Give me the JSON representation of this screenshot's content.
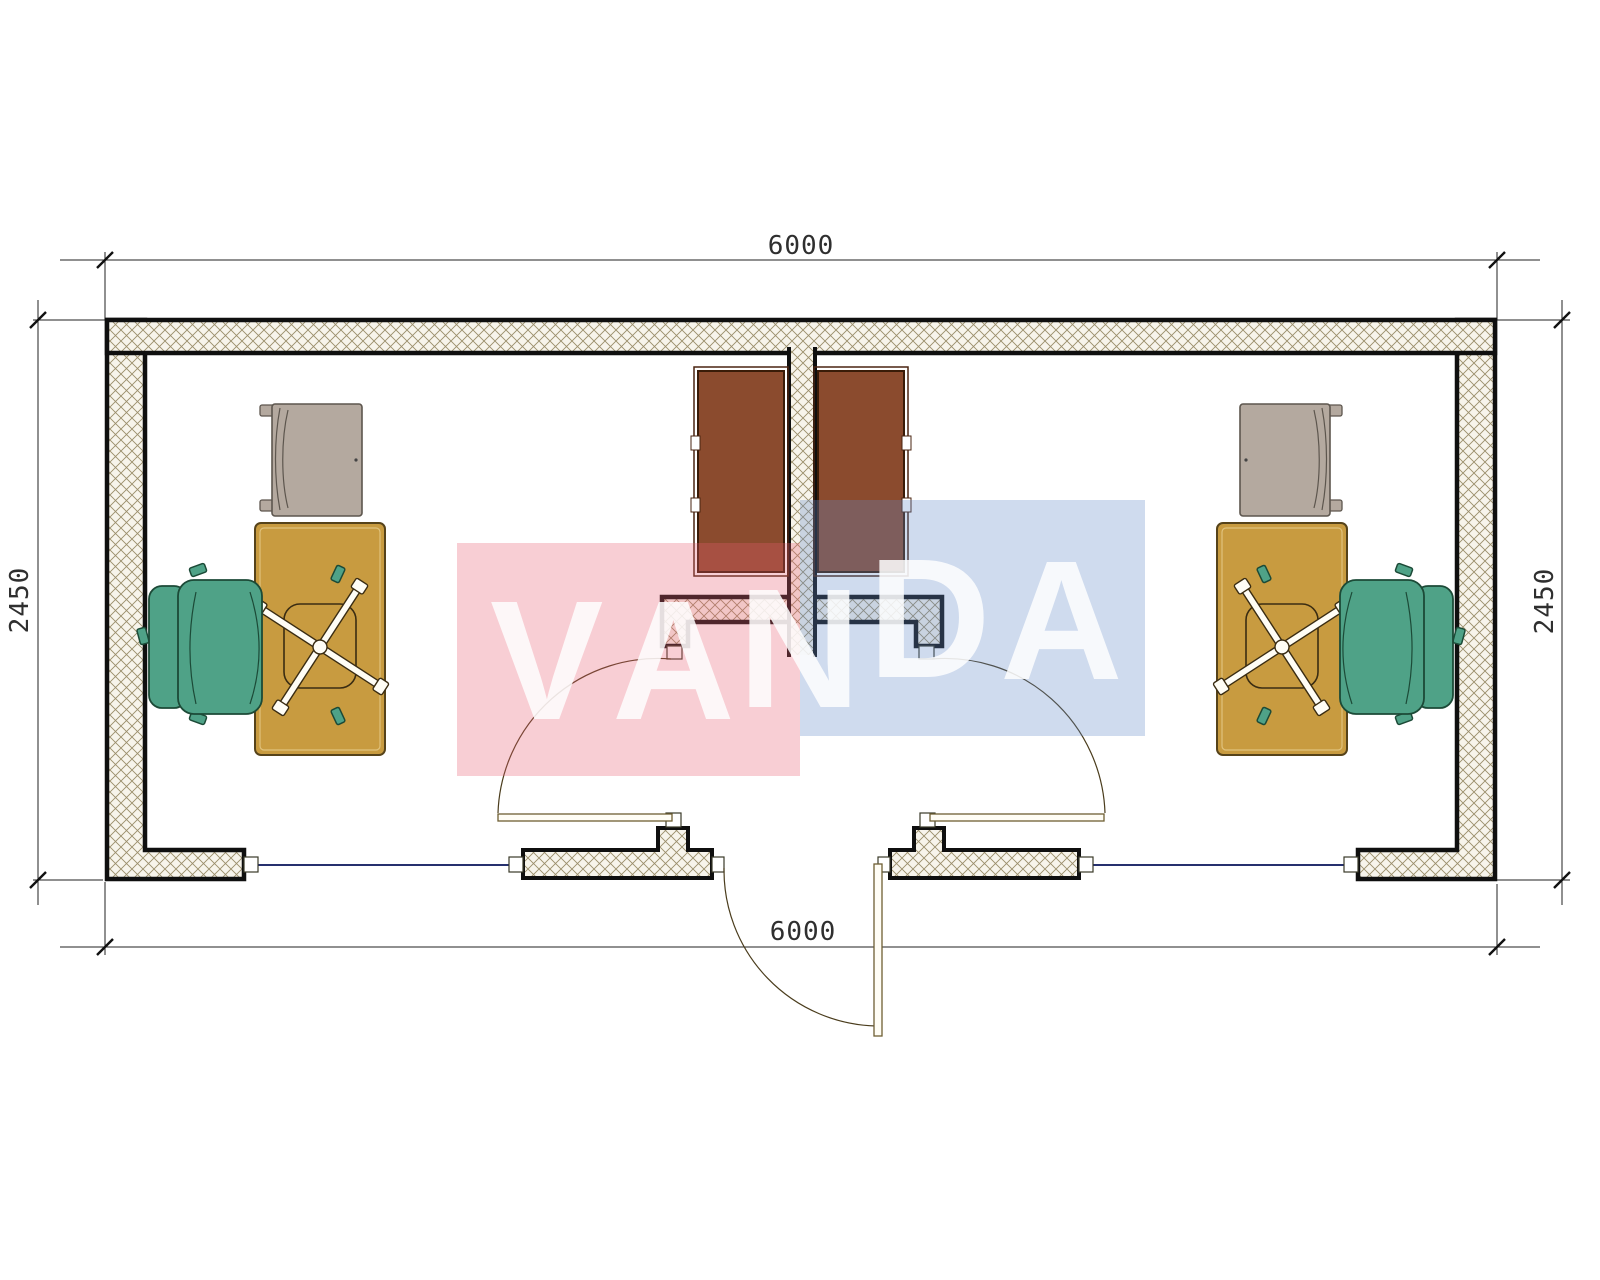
{
  "title": "container-office-floor-plan",
  "dims": {
    "width_top": "6000",
    "width_bottom": "6000",
    "height_left": "2450",
    "height_right": "2450"
  },
  "watermark": {
    "letters": [
      "V",
      "A",
      "N",
      "D",
      "A"
    ],
    "pink": "#e85d72",
    "blue": "#6089c8",
    "letter_color": "#ffffff"
  },
  "colors": {
    "wall_hatch_line": "#9a8e6a",
    "wall_hatch_bg": "#f7f4eb",
    "wall_line": "#0f0f0f",
    "desk": "#c89b40",
    "office_chair": "#4fa287",
    "armchair": "#b4a99f",
    "cabinet": "#8b4b2e",
    "window_line": "#26306e",
    "door_line": "#6e5f33",
    "dim_text": "#2f2f2f"
  },
  "furniture": {
    "left_room": [
      "armchair",
      "desk",
      "task-chair",
      "office-chair",
      "cabinet"
    ],
    "right_room": [
      "armchair",
      "desk",
      "task-chair",
      "office-chair",
      "cabinet"
    ]
  }
}
